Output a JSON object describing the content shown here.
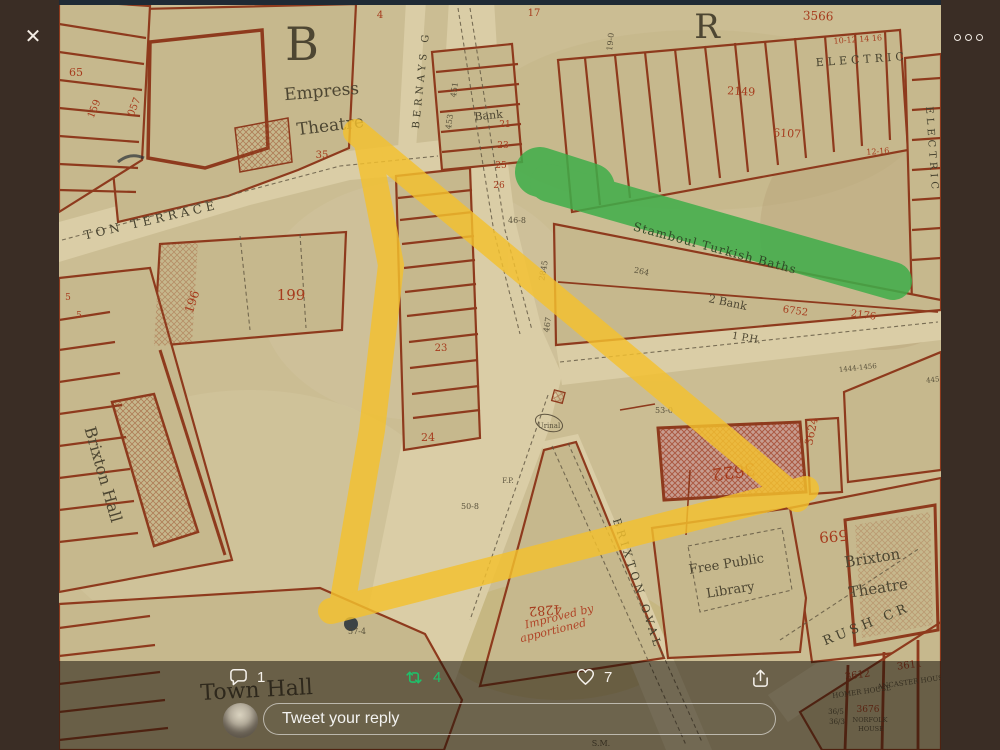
{
  "lightbox": {
    "close_icon": "✕",
    "icons": {
      "close": "x-mark",
      "more": "three-dots-horizontal",
      "reply": "speech-bubble",
      "retweet": "retweet-arrows",
      "like": "heart-outline",
      "share": "share-up-arrow"
    }
  },
  "actions": {
    "reply_count": "1",
    "retweet_count": "4",
    "like_count": "7"
  },
  "reply_box": {
    "placeholder": "Tweet your reply"
  },
  "colors": {
    "backdrop": "#3a2d25",
    "top_strip": "#1f2a35",
    "icon_white": "#f6f2ec",
    "retweet_green": "#1fc06a",
    "map_tan": "#cbbd93",
    "map_street": "#dacda6",
    "map_red_line": "#8e3a1d",
    "map_olive_text": "#4d4632",
    "map_red_text": "#a63b1d",
    "route_highlight_yellow": "#f4c12e",
    "baths_highlight_green": "#3fae4a"
  },
  "map": {
    "highlights": {
      "route": "hand-drawn yellow triangle route",
      "baths": "green band over Stamboul Turkish Baths"
    },
    "labels": [
      {
        "text": "B"
      },
      {
        "text": "Empress"
      },
      {
        "text": "Theatre"
      },
      {
        "text": "BERNAYS G"
      },
      {
        "text": "Bank"
      },
      {
        "text": "TON TERRACE"
      },
      {
        "text": "199"
      },
      {
        "text": "196"
      },
      {
        "text": "Brixton Hall"
      },
      {
        "text": "Stamboul Turkish Baths"
      },
      {
        "text": "2 Bank"
      },
      {
        "text": "1 P.H."
      },
      {
        "text": "ELECTRIC"
      },
      {
        "text": "ELECTRIC"
      },
      {
        "text": "BRIXTON OVAL"
      },
      {
        "text": "Free Public"
      },
      {
        "text": "Library"
      },
      {
        "text": "Brixton"
      },
      {
        "text": "Theatre"
      },
      {
        "text": "599"
      },
      {
        "text": "3622"
      },
      {
        "text": "3624"
      },
      {
        "text": "Town Hall"
      },
      {
        "text": "RUSH CR"
      },
      {
        "text": "3612"
      },
      {
        "text": "3611"
      },
      {
        "text": "HOMER HOUSE"
      },
      {
        "text": "ANCASTER HOUSE"
      },
      {
        "text": "Improved by"
      },
      {
        "text": "apportioned"
      },
      {
        "text": "4282"
      },
      {
        "text": "Urinal"
      },
      {
        "text": "F.P."
      },
      {
        "text": "S.M."
      },
      {
        "text": "57-4"
      },
      {
        "text": "50-8"
      },
      {
        "text": "46-8"
      },
      {
        "text": "53-0"
      },
      {
        "text": "2845"
      },
      {
        "text": "451"
      },
      {
        "text": "453"
      },
      {
        "text": "467"
      },
      {
        "text": "3566"
      },
      {
        "text": "2149"
      },
      {
        "text": "6107"
      },
      {
        "text": "6752"
      },
      {
        "text": "2176"
      },
      {
        "text": "65"
      },
      {
        "text": "159"
      },
      {
        "text": "057"
      },
      {
        "text": "21"
      },
      {
        "text": "23"
      },
      {
        "text": "25"
      },
      {
        "text": "26"
      },
      {
        "text": "24"
      },
      {
        "text": "23"
      },
      {
        "text": "35"
      },
      {
        "text": "4"
      },
      {
        "text": "17"
      },
      {
        "text": "1444-1456"
      },
      {
        "text": "445"
      },
      {
        "text": "10-12 14 16"
      },
      {
        "text": "12-16"
      },
      {
        "text": "264"
      },
      {
        "text": "19-0"
      },
      {
        "text": "3676"
      },
      {
        "text": "NORFOLK"
      },
      {
        "text": "HOUSE"
      },
      {
        "text": "36/5"
      },
      {
        "text": "36/3"
      },
      {
        "text": "R"
      },
      {
        "text": "5"
      },
      {
        "text": "5"
      }
    ]
  }
}
